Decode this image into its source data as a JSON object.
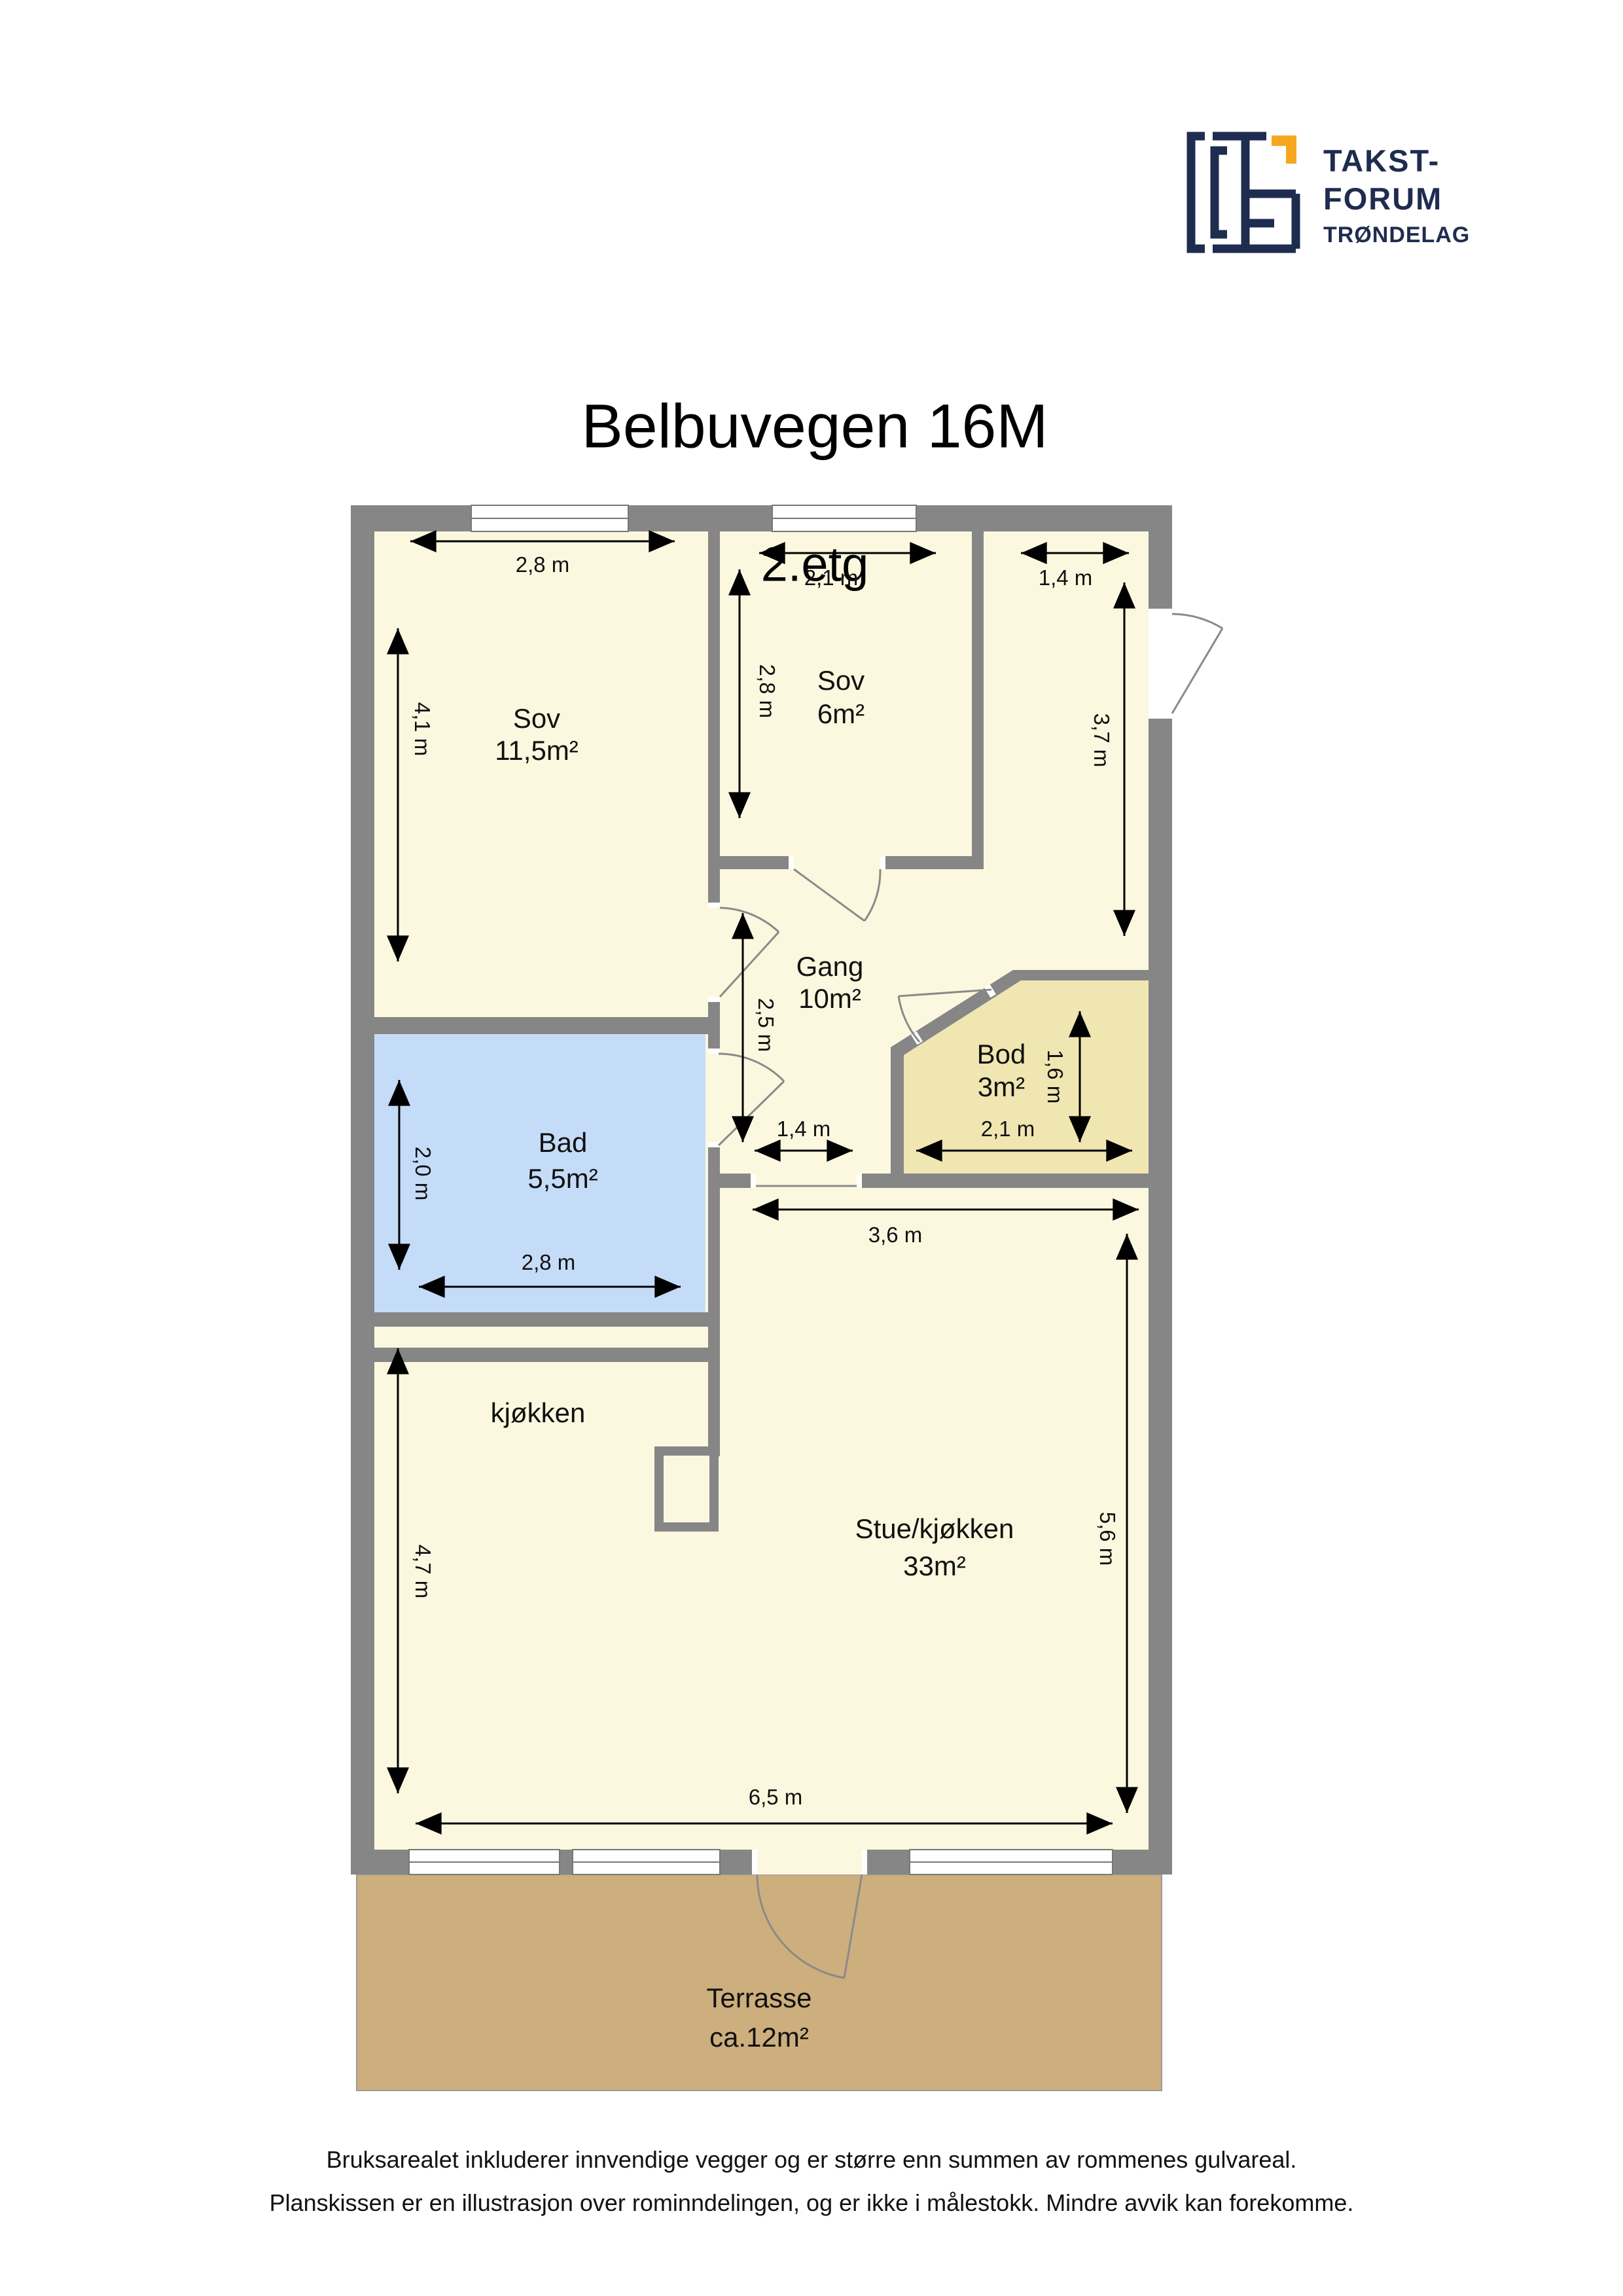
{
  "title": "Belbuvegen 16M",
  "subtitle": "2.etg",
  "logo": {
    "line1": "TAKST-",
    "line2": "FORUM",
    "line3": "TRØNDELAG"
  },
  "rooms": {
    "sov1": {
      "name": "Sov",
      "area": "11,5m²"
    },
    "sov2": {
      "name": "Sov",
      "area": "6m²"
    },
    "gang": {
      "name": "Gang",
      "area": "10m²"
    },
    "bod": {
      "name": "Bod",
      "area": "3m²"
    },
    "bad": {
      "name": "Bad",
      "area": "5,5m²"
    },
    "kjokken": {
      "name": "kjøkken"
    },
    "stue": {
      "name": "Stue/kjøkken",
      "area": "33m²"
    },
    "terrasse": {
      "name": "Terrasse",
      "area": "ca.12m²"
    }
  },
  "dimensions": {
    "sov1_width": "2,8 m",
    "sov1_height": "4,1 m",
    "sov2_width": "2,1 m",
    "sov2_height": "2,8 m",
    "entry_width": "1,4 m",
    "entry_height": "3,7 m",
    "gang_height": "2,5 m",
    "gang_width": "1,4 m",
    "bod_height": "1,6 m",
    "bod_width": "2,1 m",
    "bad_height": "2,0 m",
    "bad_width": "2,8 m",
    "stue_width": "3,6 m",
    "stue_height": "5,6 m",
    "kjokken_height": "4,7 m",
    "total_width": "6,5 m"
  },
  "footer": {
    "line1": "Bruksarealet inkluderer innvendige vegger og er større enn summen av rommenes gulvareal.",
    "line2": "Planskissen er en illustrasjon over rominndelingen, og er ikke i målestokk. Mindre avvik kan forekomme."
  },
  "colors": {
    "wall": "#868686",
    "floor": "#FBF8DF",
    "bathroom": "#C5DCF8",
    "storage": "#F0E6B2",
    "terrace": "#CDAE7D",
    "logo_navy": "#1E2C4F",
    "logo_orange": "#F5A81F"
  }
}
